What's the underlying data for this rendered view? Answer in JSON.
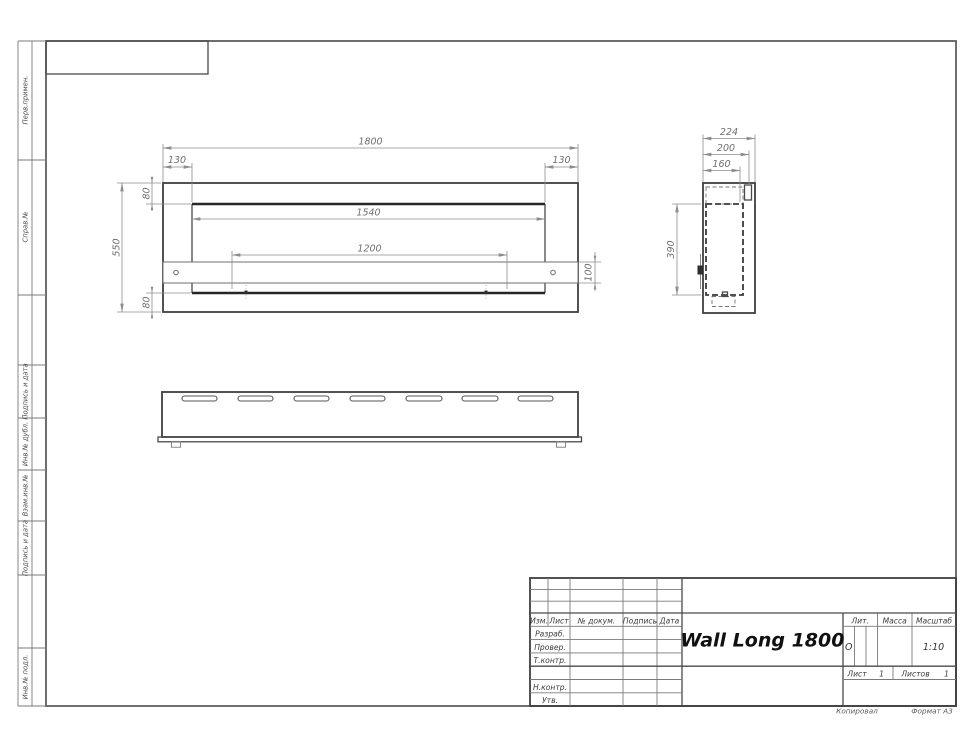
{
  "drawing": {
    "title": "Wall Long 1800",
    "scale": "1:10",
    "liter": "О",
    "sheet_number": "1",
    "sheets_total": "1",
    "copied_label": "Копировал",
    "format_label": "Формат А3"
  },
  "title_block": {
    "col_izm": "Изм.",
    "col_list": "Лист",
    "col_doc": "№ докум.",
    "col_sign": "Подпись",
    "col_date": "Дата",
    "row_developed": "Разраб.",
    "row_checked": "Провер.",
    "row_tcontrol": "Т.контр.",
    "row_ncontrol": "Н.контр.",
    "row_approved": "Утв.",
    "lit_label": "Лит.",
    "mass_label": "Масса",
    "scale_label": "Масштаб",
    "sheet_label": "Лист",
    "sheets_label": "Листов"
  },
  "margin_labels": {
    "first_use": "Перв.примен.",
    "ref_number": "Справ.№",
    "sign_date_1": "Подпись и дата",
    "inv_dup": "Инв.№ дубл.",
    "repl_inv": "Взам.инв.№",
    "sign_date_2": "Подпись и дата",
    "inv_orig": "Инв.№ подл."
  },
  "dimensions": {
    "front": {
      "overall_width": "1800",
      "left_offset": "130",
      "right_offset": "130",
      "top_border": "80",
      "opening_width": "1540",
      "burner_spacing": "1200",
      "overall_height": "550",
      "band_height": "100",
      "bottom_border": "80"
    },
    "side": {
      "overall_depth": "224",
      "depth_200": "200",
      "depth_160": "160",
      "inner_height": "390"
    }
  }
}
